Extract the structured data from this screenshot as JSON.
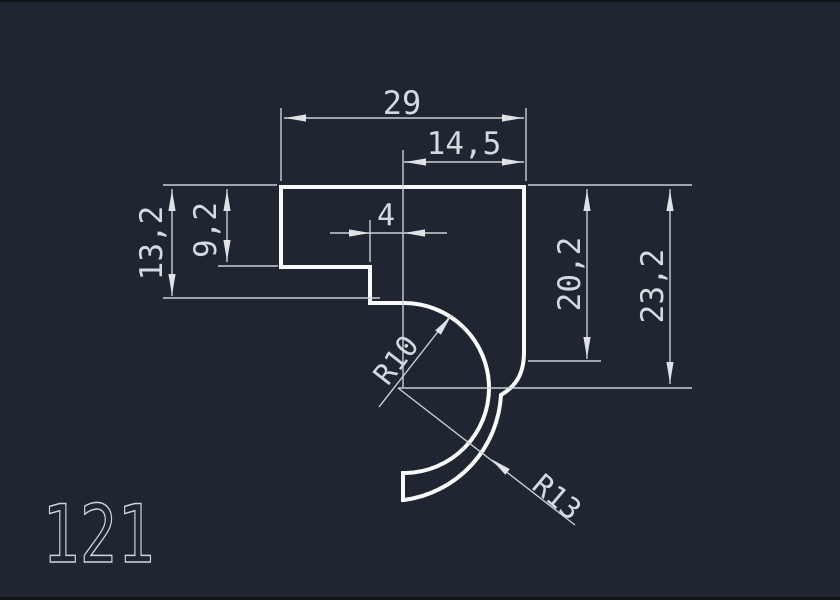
{
  "drawing": {
    "part_number": "121",
    "dims": {
      "total_width": "29",
      "right_width": "14,5",
      "tab_width": "4",
      "left_height_outer": "13,2",
      "left_height_inner": "9,2",
      "right_height_inner": "20,2",
      "right_height_outer": "23,2",
      "inner_radius": "R10",
      "outer_radius": "R13"
    },
    "colors": {
      "background": "#202631",
      "profile_line": "#f8fafb",
      "dimension_line": "#c9cfd6",
      "text": "#d5dae0"
    }
  }
}
